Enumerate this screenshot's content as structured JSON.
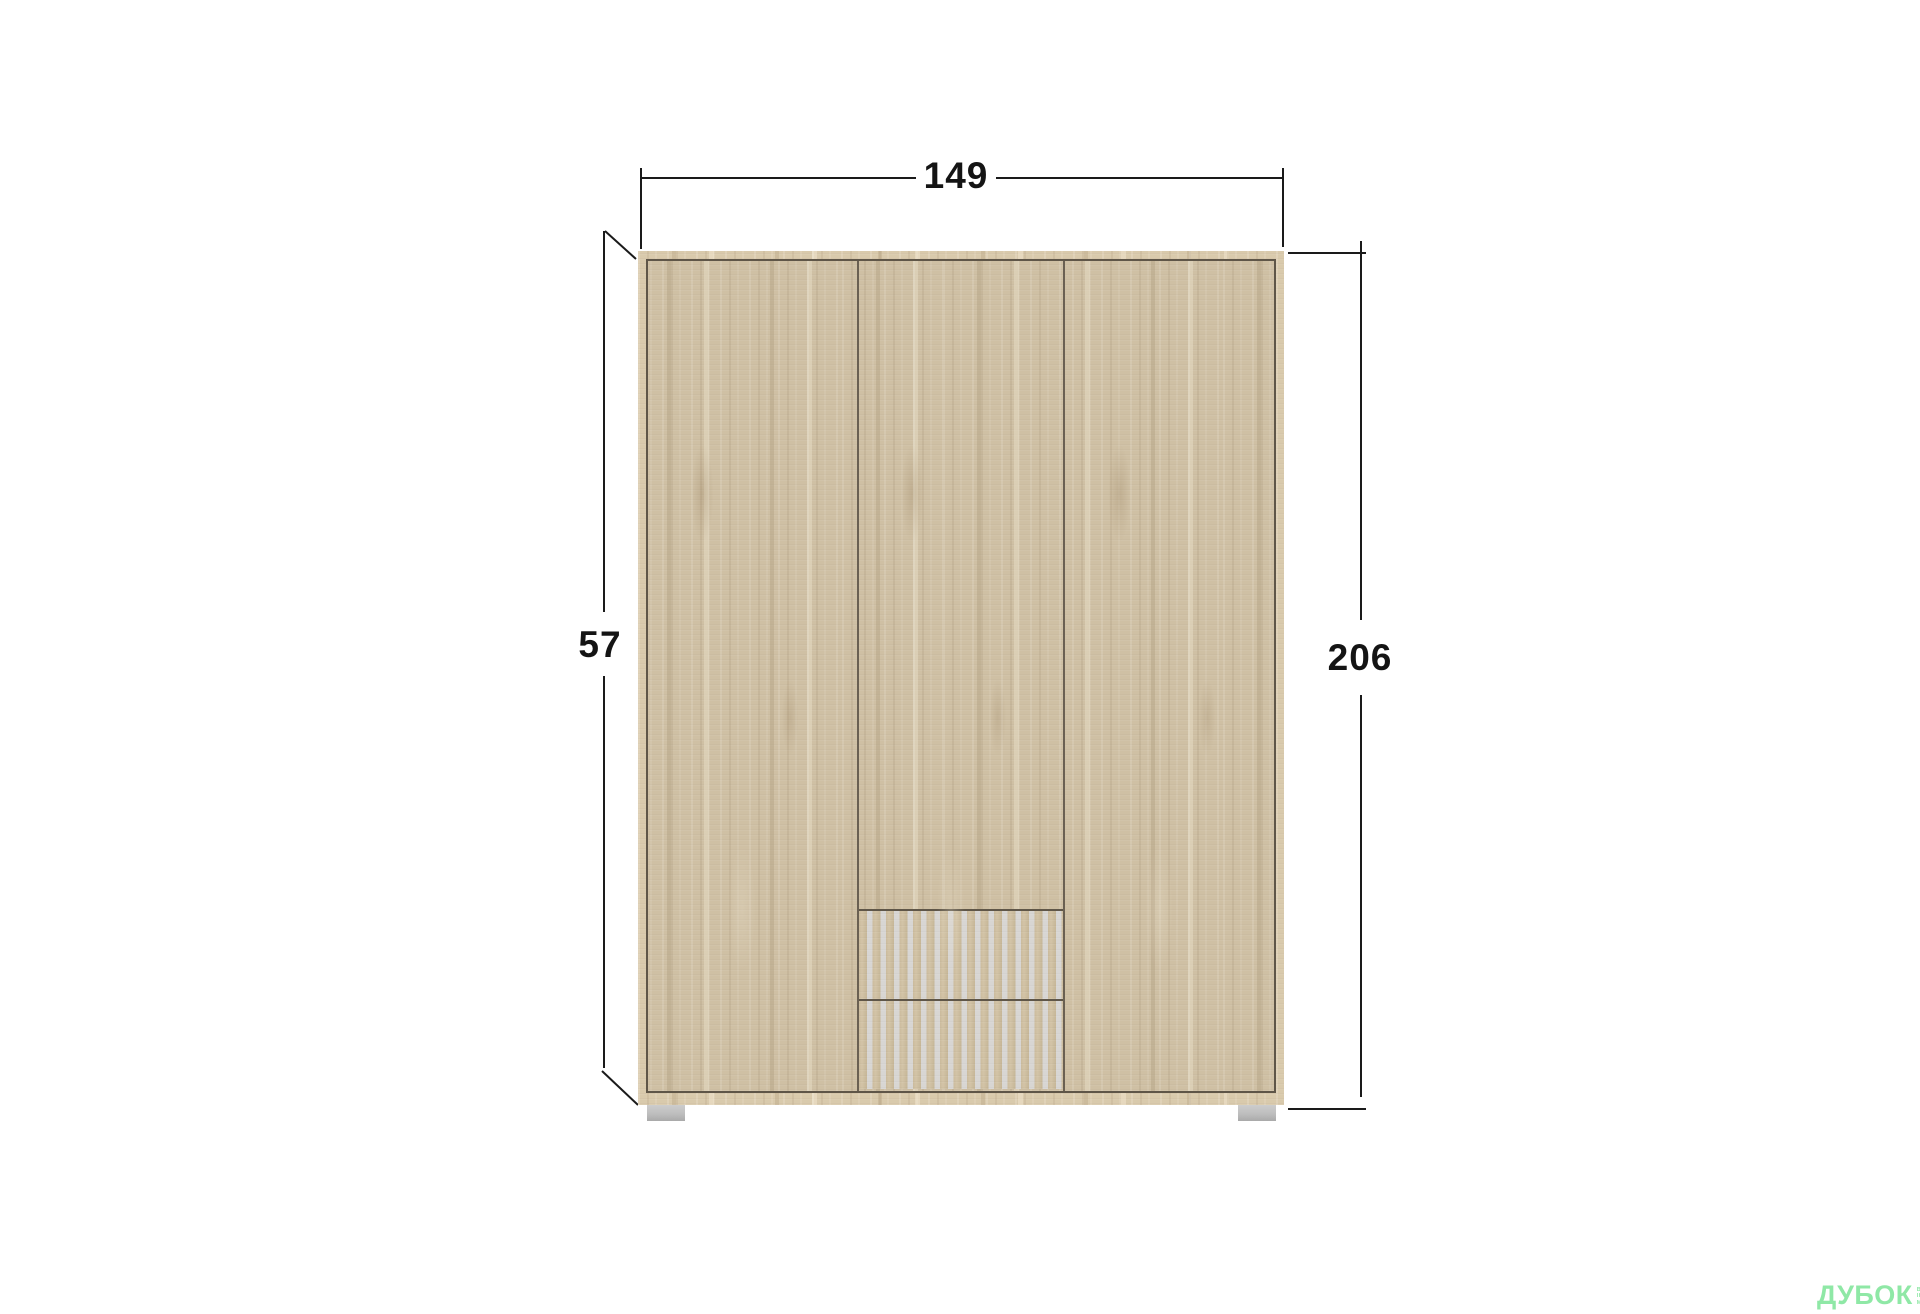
{
  "diagram": {
    "description": "Front view of a three-door wardrobe in sonoma oak with two slatted drawers and overall dimensions",
    "dimensions": {
      "width": "149",
      "height": "206",
      "depth": "57"
    },
    "colors": {
      "background": "#ffffff",
      "dimension_lines": "#1a1a1a",
      "wood_base": "#cfc0a4",
      "wood_light_streak": "#e5dac3",
      "wood_dark_streak": "#b2a183",
      "frame_line": "#5f5648",
      "slat_gap_gray": "#d8d6d3",
      "feet_gray": "#bcbcbc",
      "watermark_green": "#8fe8a6"
    },
    "watermark": {
      "brand": "ДУБОК",
      "tagline_lines": [
        "ВАШІ",
        "ІНТЕРНЕТ",
        "МЕБЛІ"
      ]
    }
  }
}
